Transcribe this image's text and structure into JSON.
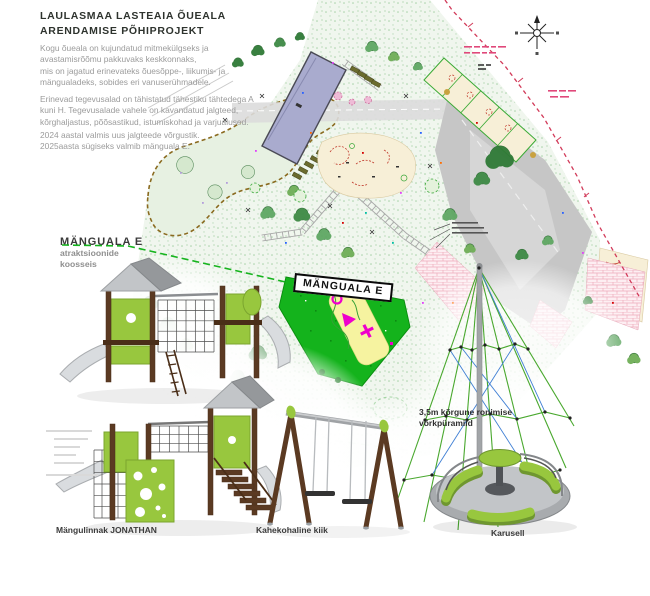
{
  "title": {
    "line1": "LAULASMAA LASTEAIA ÕUEALA",
    "line2": "ARENDAMISE PÕHIPROJEKT"
  },
  "intro": {
    "p1l1": "Kogu õueala on kujundatud mitmekülgseks ja",
    "p1l2": "avastamisrõõmu pakkuvaks keskkonnaks,",
    "p1l3": "mis on jagatud erinevateks õuesõppe-, liikumis- ja",
    "p1l4": "mängualadeks, sobides eri vanuserühmadele.",
    "p2l1": "Erinevad tegevusalad on tähistatud tähestiku tähtedega A",
    "p2l2": "kuni H. Tegevusalade vahele on kavandatud jalgteed,",
    "p2l3": "kõrghaljastus, põõsastikud, istumiskohad ja varjualused.",
    "p3l1": "2024 aastal valmis uus jalgteede võrgustik.",
    "p3l2": "2025aasta sügiseks valmib mänguala E."
  },
  "area_callout": {
    "heading": "MÄNGUALA E",
    "subtitle_line1": "atraktsioonide",
    "subtitle_line2": "koosseis"
  },
  "plan": {
    "area_label": "MÄNGUALA E"
  },
  "equipment": {
    "playhouse_label": "Mängulinnak JONATHAN",
    "swing_label": "Kahekohaline kiik",
    "carousel_label": "Karusell",
    "pyramid_note_line1": "3,5m kõrgune ronimise",
    "pyramid_note_line2": "võrkpüramiid"
  },
  "icons": {
    "compass": "north-arrow-icon"
  },
  "colors": {
    "highlight_green": "#14b31c",
    "equipment_lime": "#98c73e",
    "title_text": "#2e332e",
    "body_text": "#9b9b9b",
    "boundary_red": "#d23b5a",
    "building_fill": "#a9abce"
  }
}
